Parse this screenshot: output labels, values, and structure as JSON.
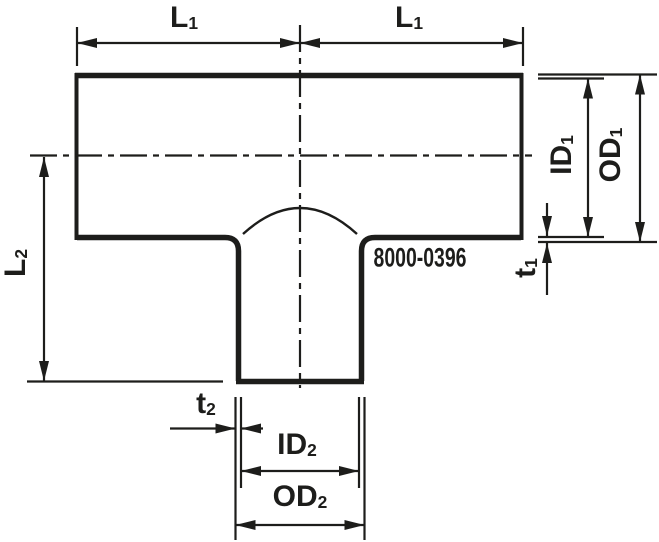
{
  "diagram": {
    "type": "technical-drawing",
    "subject": "tee-reducing-pipe-fitting",
    "part_number": "8000-0396",
    "colors": {
      "line": "#1d1d1b",
      "background": "#ffffff"
    },
    "labels": {
      "l1_left": {
        "base": "L",
        "sub": "1"
      },
      "l1_right": {
        "base": "L",
        "sub": "1"
      },
      "l2": {
        "base": "L",
        "sub": "2"
      },
      "id1": {
        "base": "ID",
        "sub": "1"
      },
      "od1": {
        "base": "OD",
        "sub": "1"
      },
      "t1": {
        "base": "t",
        "sub": "1"
      },
      "t2": {
        "base": "t",
        "sub": "2"
      },
      "id2": {
        "base": "ID",
        "sub": "2"
      },
      "od2": {
        "base": "OD",
        "sub": "2"
      }
    }
  }
}
